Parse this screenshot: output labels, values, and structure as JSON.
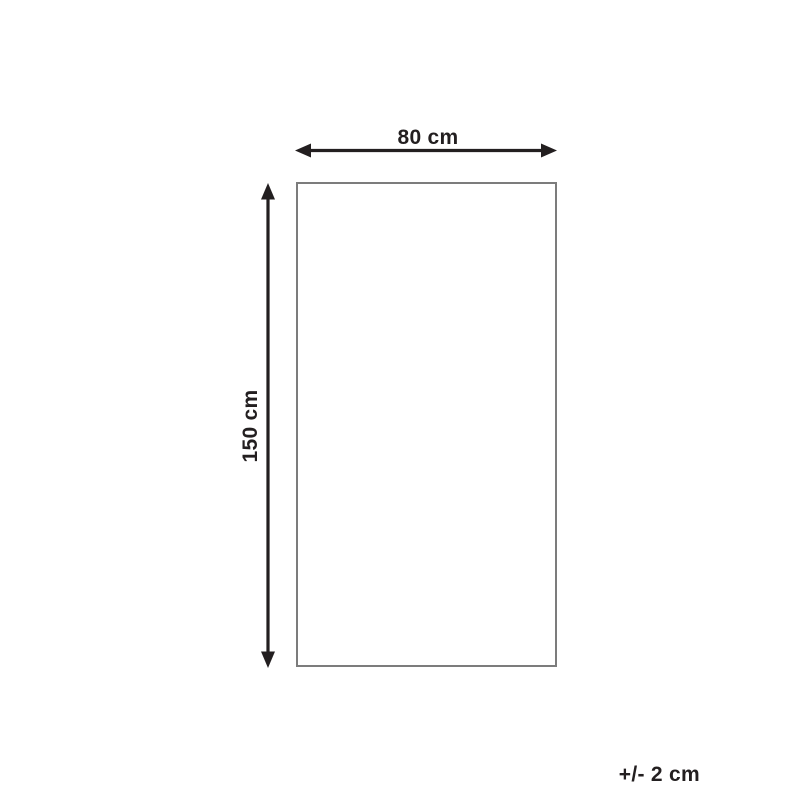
{
  "diagram": {
    "width_label": "80 cm",
    "height_label": "150 cm",
    "tolerance_label": "+/- 2 cm",
    "colors": {
      "dimension": "#231f20",
      "outline": "#7c7c7c",
      "background": "#ffffff"
    }
  }
}
